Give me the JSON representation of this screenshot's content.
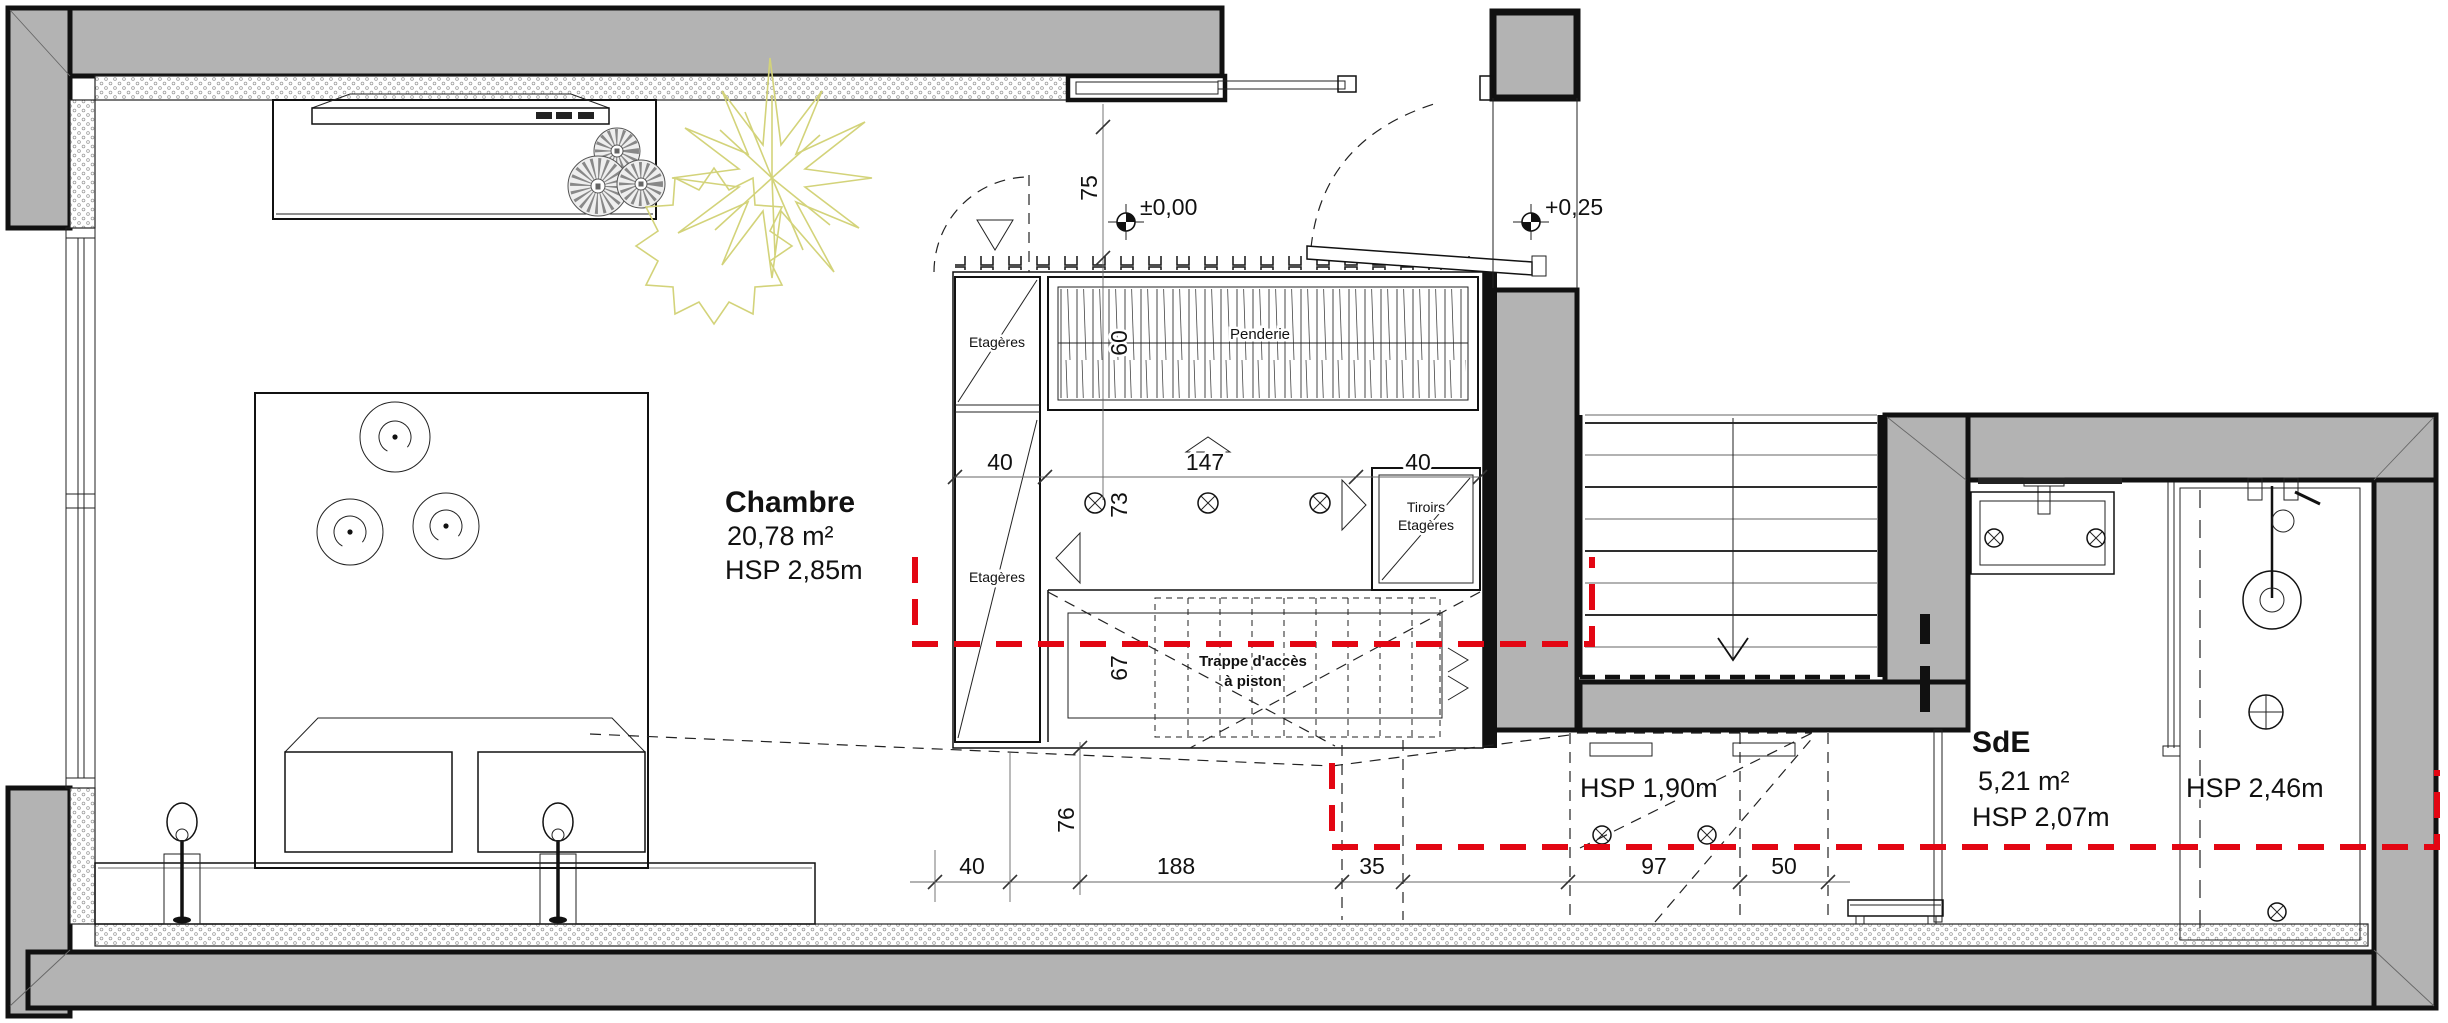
{
  "colors": {
    "wall": "#b3b3b3",
    "section_line": "#e30613",
    "plant": "#d3d37a",
    "text": "#111111"
  },
  "rooms": {
    "chambre": {
      "name": "Chambre",
      "area": "20,78 m²",
      "height": "HSP 2,85m"
    },
    "sde": {
      "name": "SdE",
      "area": "5,21 m²",
      "height": "HSP 2,07m"
    },
    "shower_zone": {
      "height": "HSP 2,46m"
    },
    "under_stairs_zone": {
      "height": "HSP 1,90m"
    }
  },
  "levels": {
    "room": "±0,00",
    "entry": "+0,25"
  },
  "wardrobe": {
    "penderie": "Penderie",
    "shelves_top": "Etagères",
    "shelves_bottom": "Etagères",
    "drawers_line1": "Tiroirs",
    "drawers_line2": "Etagères",
    "hatch_line1": "Trappe d'accès",
    "hatch_line2": "à piston"
  },
  "dims": {
    "top_offset": "75",
    "penderie_depth": "60",
    "closet_left": "40",
    "closet_mid": "147",
    "closet_right": "40",
    "closet_inner": "73",
    "trappe": "67",
    "bed_gap": "76",
    "bottom": [
      "40",
      "188",
      "35",
      "97",
      "50"
    ]
  }
}
